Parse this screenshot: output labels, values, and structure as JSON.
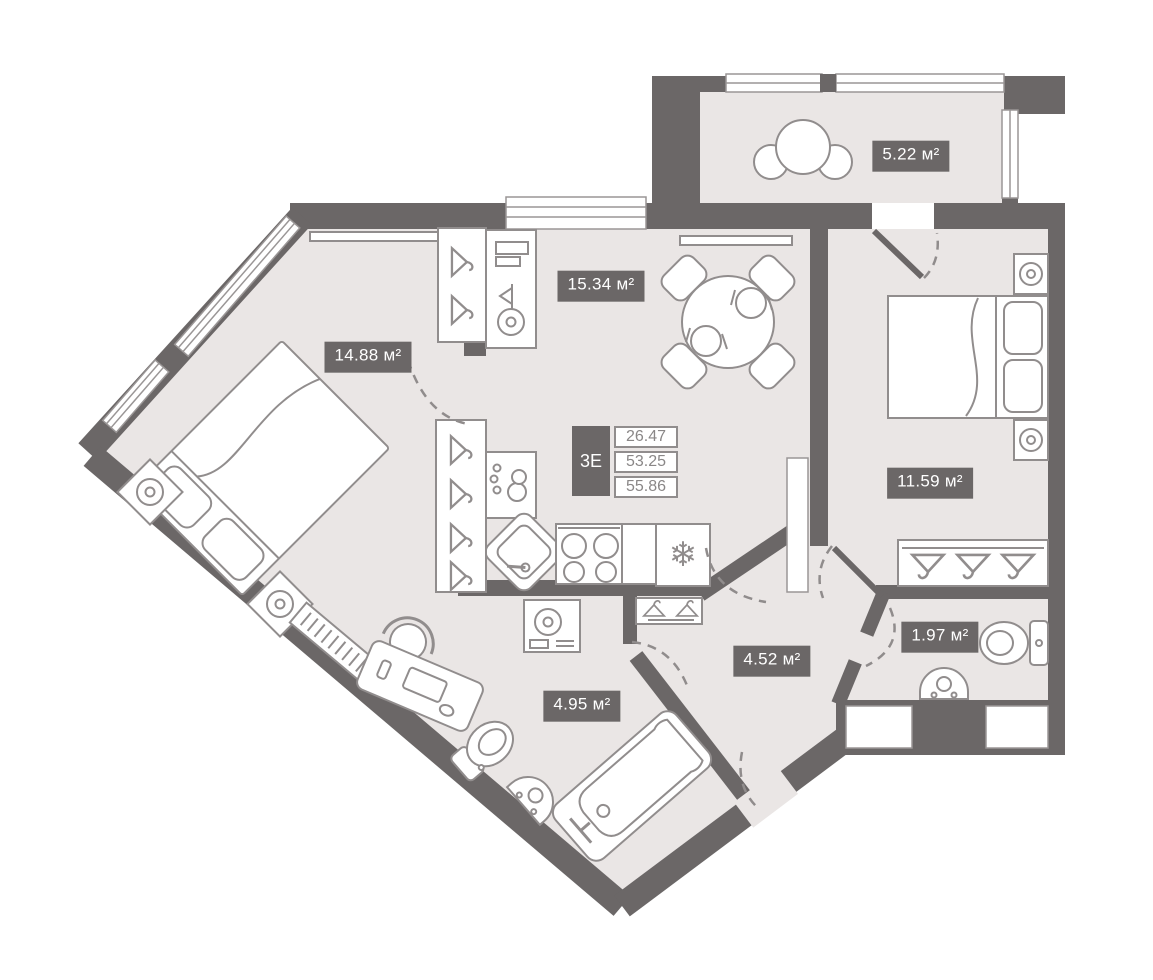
{
  "plan": {
    "unit_type_label": "3Е",
    "spec_values": {
      "v1": "26.47",
      "v2": "53.25",
      "v3": "55.86"
    },
    "rooms": [
      {
        "name": "balcony",
        "area": "5.22 м²"
      },
      {
        "name": "kitchen-living",
        "area": "15.34 м²"
      },
      {
        "name": "bedroom-left",
        "area": "14.88 м²"
      },
      {
        "name": "bedroom-right",
        "area": "11.59 м²"
      },
      {
        "name": "hallway",
        "area": "4.52 м²"
      },
      {
        "name": "wc",
        "area": "1.97 м²"
      },
      {
        "name": "bathroom",
        "area": "4.95 м²"
      }
    ],
    "icons": {
      "fridge_snowflake": "❄"
    },
    "colors": {
      "wall": "#6b6767",
      "floor": "#eae6e5",
      "furniture_line": "#918d8d",
      "label_bg": "#6b6767",
      "label_text": "#ffffff"
    }
  }
}
